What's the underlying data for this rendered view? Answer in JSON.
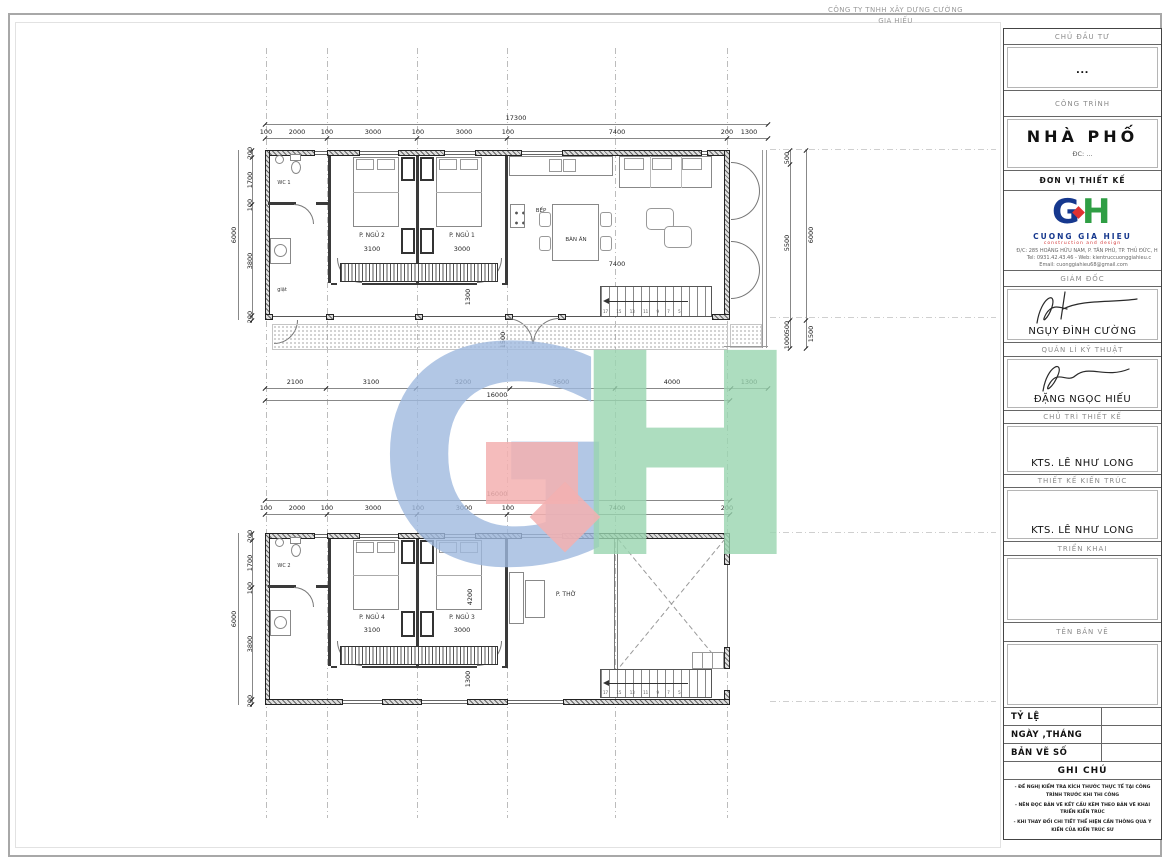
{
  "sheet": {
    "company_header": {
      "line1": "CÔNG TY TNHH XÂY DỰNG CƯỜNG",
      "line2": "GIA HIẾU"
    }
  },
  "title_block": {
    "investor": {
      "label": "CHỦ ĐẦU TƯ",
      "value": "..."
    },
    "project": {
      "label": "CÔNG TRÌNH",
      "name": "NHÀ PHỐ",
      "address": "ĐC:  ..."
    },
    "design_firm": {
      "label": "ĐƠN VỊ THIẾT KẾ",
      "logo_g": "G",
      "logo_h": "H",
      "company": "CUONG GIA HIEU",
      "tagline": "construction and design",
      "address": "Đ/C: 285 HOÀNG HỮU NAM, P. TÂN PHÚ, TP. THỦ ĐỨC, H",
      "tel_web": "Tel: 0931.42.43.46  -  Web: kientruccuonggiahieu.c",
      "email": "Email: cuonggiahieu68@gmail.com",
      "brand_blue": "#16388e",
      "brand_green": "#2f9e44",
      "brand_red": "#e03131"
    },
    "director": {
      "label": "GIÁM ĐỐC",
      "name": "NGỤY ĐÌNH CƯỜNG"
    },
    "technical_manager": {
      "label": "QUẢN LÍ KỸ THUẬT",
      "name": "ĐẶNG NGỌC HIẾU"
    },
    "lead_designer": {
      "label": "CHỦ TRÌ THIẾT KẾ",
      "name": "KTS. LÊ NHƯ LONG"
    },
    "architect": {
      "label": "THIẾT KẾ KIẾN TRÚC",
      "name": "KTS. LÊ NHƯ LONG"
    },
    "deployment": {
      "label": "TRIỂN KHAI"
    },
    "drawing_name": {
      "label": "TÊN BẢN VẼ"
    },
    "scale": {
      "label": "TỶ LỆ"
    },
    "date": {
      "label": "NGÀY ,THÁNG"
    },
    "drawing_number": {
      "label": "BẢN VẼ SỐ"
    },
    "notes": {
      "label": "GHI CHÚ",
      "items": [
        "- ĐỀ NGHỊ KIỂM TRA KÍCH THƯỚC THỰC TẾ TẠI CÔNG TRÌNH TRƯỚC KHI THI CÔNG",
        "- NÊN ĐỌC BẢN VẼ KẾT CẤU KÈM THEO BẢN VẼ KHAI TRIỂN KIẾN TRÚC",
        "- KHI THAY ĐỔI CHI TIẾT THỂ HIỆN CẦN THÔNG QUA Ý KIẾN CỦA KIẾN TRÚC SƯ"
      ]
    }
  },
  "plan_top": {
    "total_width": "17300",
    "dims_top": [
      "100",
      "2000",
      "100",
      "3000",
      "100",
      "3000",
      "100",
      "7400",
      "200",
      "1300"
    ],
    "dims_left": [
      "200",
      "1700",
      "100",
      "3800",
      "200"
    ],
    "total_left": "6000",
    "dims_right": [
      "500",
      "5500"
    ],
    "total_right": "6000",
    "dims_right_lower": [
      "500",
      "1000"
    ],
    "total_right_lower": "1500",
    "dims_bottom": [
      "2100",
      "3100",
      "3200",
      "3600",
      "4000",
      "1300"
    ],
    "total_bottom": "16000",
    "rooms": {
      "wc": "WC 1",
      "laundry": "giặt",
      "bedroom2": "P. NGỦ 2",
      "bedroom2_width": "3100",
      "bedroom1": "P. NGỦ 1",
      "bedroom1_width": "3000",
      "kitchen": "BẾP",
      "dining": "BÀN ĂN",
      "living_width": "7400",
      "hall_depth": "1300",
      "entry_depth": "1500"
    },
    "stair_numbers": "17 15 13 11 9 7 5"
  },
  "plan_bottom": {
    "total_width": "16000",
    "dims_top": [
      "100",
      "2000",
      "100",
      "3000",
      "100",
      "3000",
      "100",
      "7400",
      "200"
    ],
    "dims_left": [
      "200",
      "1700",
      "100",
      "3800",
      "200"
    ],
    "total_left": "6000",
    "rooms": {
      "wc": "WC 2",
      "bedroom4": "P. NGỦ 4",
      "bedroom4_width": "3100",
      "bedroom3": "P. NGỦ 3",
      "bedroom3_width": "3000",
      "worship": "P. THỜ",
      "bedroom_depth": "4200",
      "hall_depth": "1300"
    },
    "stair_numbers": "17 15 13 11 9 7 5"
  },
  "watermark": {
    "g": "G",
    "h": "H",
    "blue": "#9fb9de",
    "green": "#99d4af",
    "red": "#f3b0b0"
  }
}
